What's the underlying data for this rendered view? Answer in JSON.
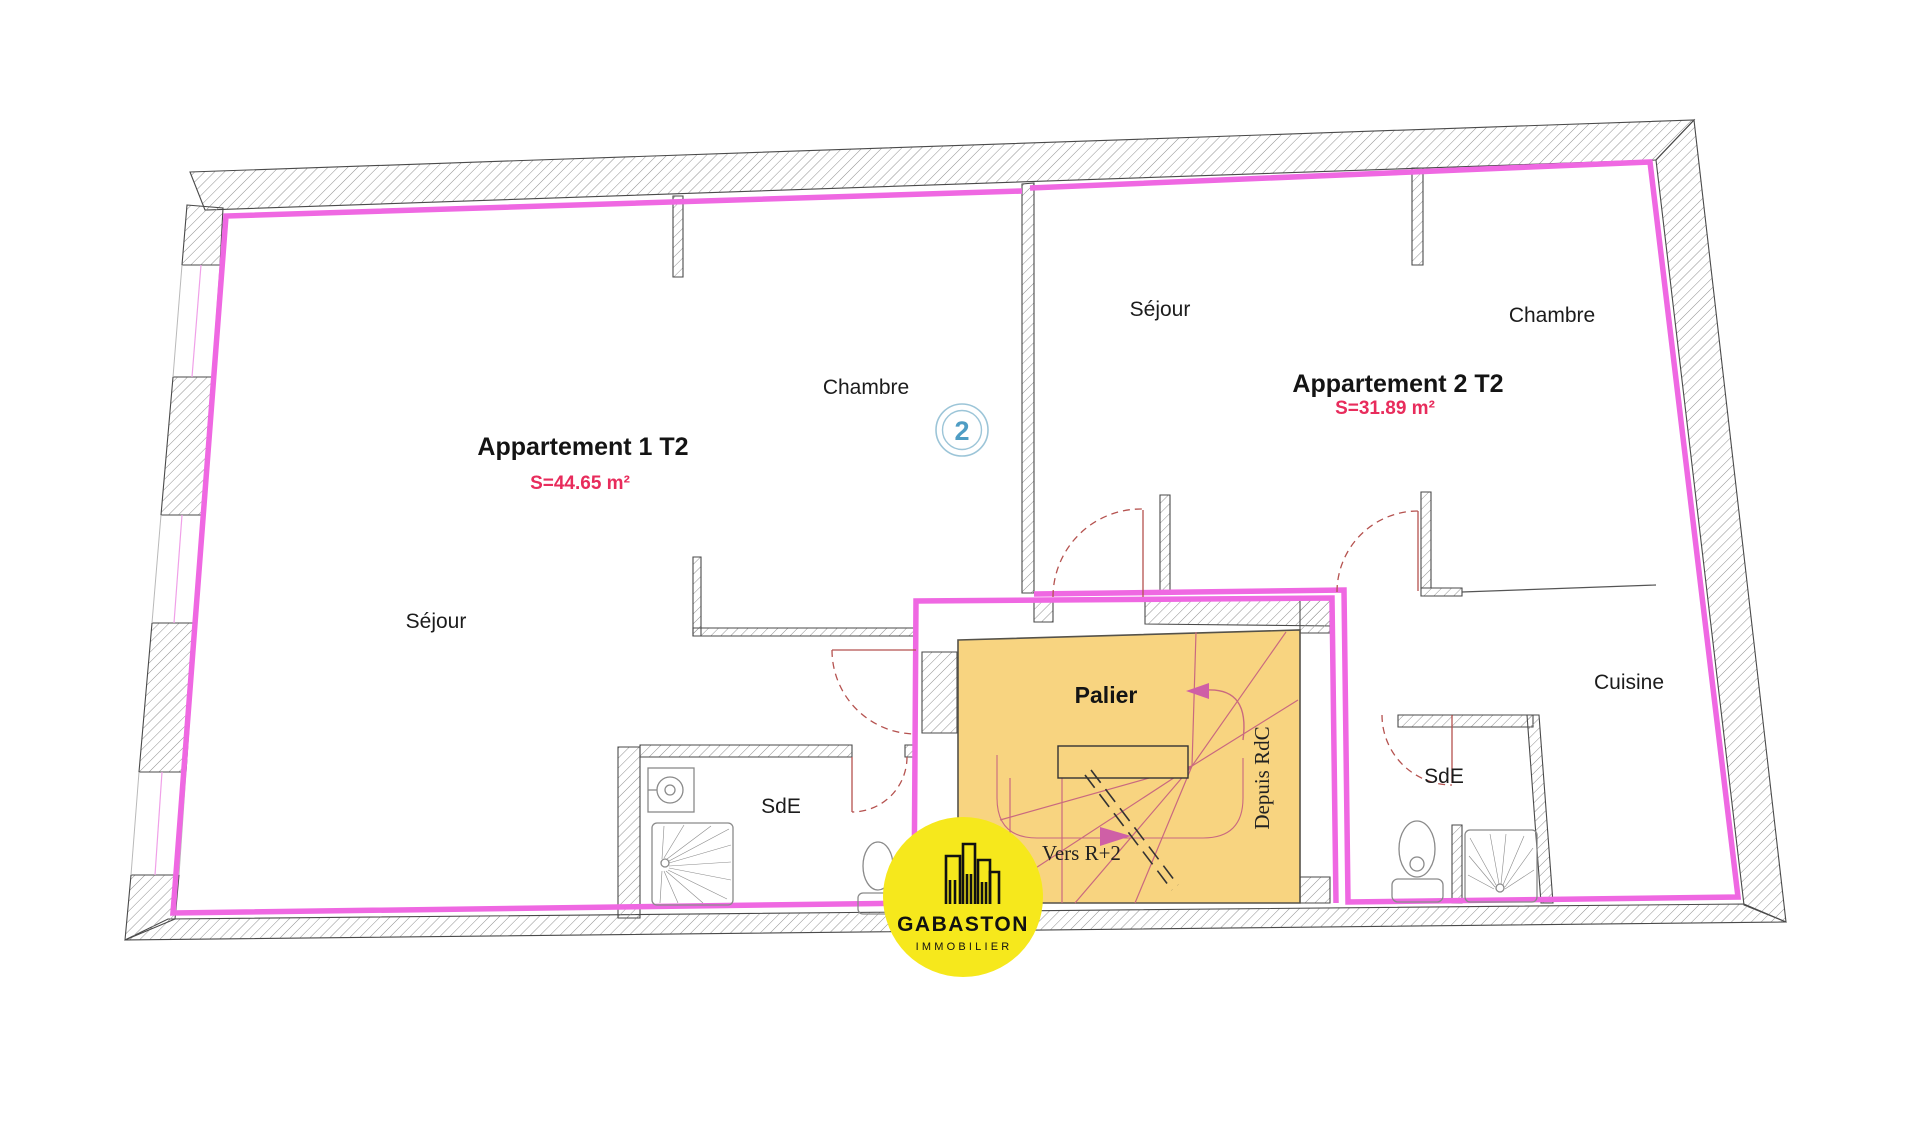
{
  "labels": {
    "apt1_name": "Appartement 1 T2",
    "apt1_area": "S=44.65 m²",
    "apt1_sejour": "Séjour",
    "apt1_chambre": "Chambre",
    "apt1_sde": "SdE",
    "apt2_name": "Appartement 2 T2",
    "apt2_area": "S=31.89 m²",
    "apt2_sejour": "Séjour",
    "apt2_chambre": "Chambre",
    "apt2_cuisine": "Cuisine",
    "apt2_sde": "SdE",
    "palier": "Palier",
    "vers_r2": "Vers R+2",
    "depuis_rdc": "Depuis RdC",
    "floor_marker": "2",
    "logo_title": "GABASTON",
    "logo_subtitle": "IMMOBILIER"
  },
  "colors": {
    "boundary_pink": "#ef68e2",
    "stair_fill": "#f8d480",
    "stair_lines": "#c9697f",
    "door_arc_red": "#b5524f",
    "area_text_crimson": "#e82c5c",
    "marker_blue": "#4f9dc4",
    "marker_ring": "#9cc5d8",
    "logo_yellow": "#f6e81c",
    "wall_hatch_gray": "#8f8f8f"
  }
}
